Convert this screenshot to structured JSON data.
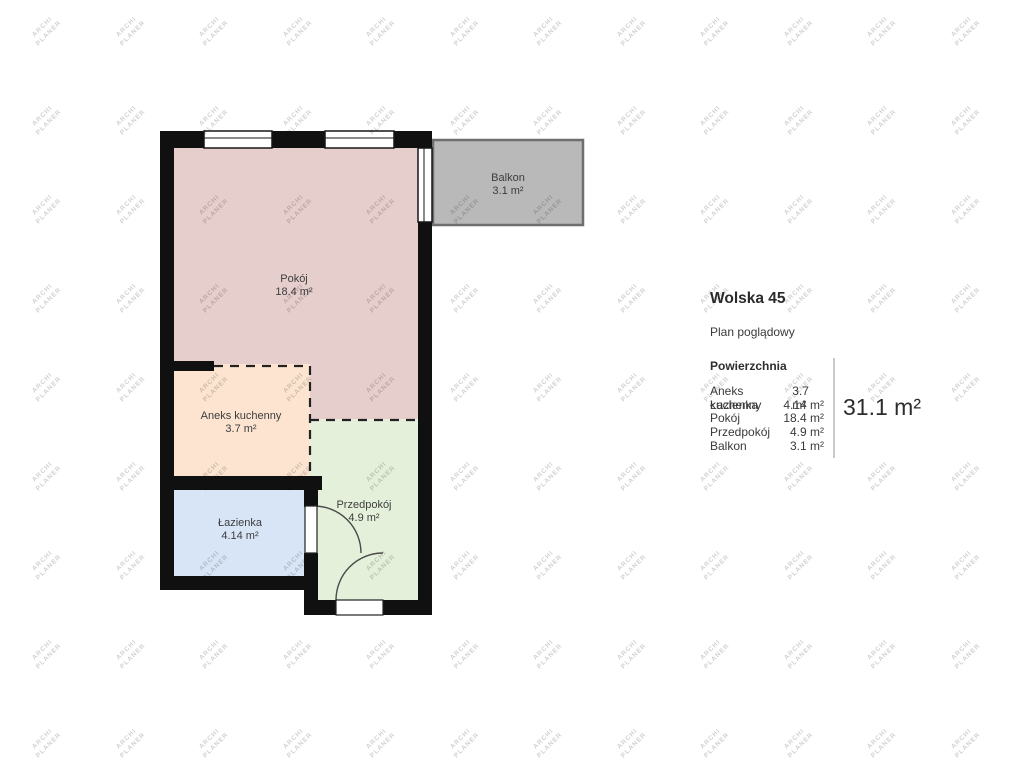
{
  "panel": {
    "title": "Wolska 45",
    "subtitle": "Plan poglądowy",
    "section_heading": "Powierzchnia",
    "rows": [
      {
        "label": "Aneks kuchenny",
        "value": "3.7 m²"
      },
      {
        "label": "Łazienka",
        "value": "4.14 m²"
      },
      {
        "label": "Pokój",
        "value": "18.4 m²"
      },
      {
        "label": "Przedpokój",
        "value": "4.9 m²"
      },
      {
        "label": "Balkon",
        "value": "3.1 m²"
      }
    ],
    "total": "31.1 m²"
  },
  "plan": {
    "wall_color": "#101010",
    "rooms": [
      {
        "name": "Pokój",
        "area": "18.4 m²",
        "color": "#e6cecd"
      },
      {
        "name": "Aneks kuchenny",
        "area": "3.7 m²",
        "color": "#fce4d0"
      },
      {
        "name": "Łazienka",
        "area": "4.14 m²",
        "color": "#d8e5f6"
      },
      {
        "name": "Przedpokój",
        "area": "4.9 m²",
        "color": "#e4f0da"
      },
      {
        "name": "Balkon",
        "area": "3.1 m²",
        "color": "#b9b9b9"
      }
    ],
    "balcony_border": "#6e6e6e"
  },
  "watermark": {
    "line1": "ARCHI",
    "line2": "PLANER",
    "color": "#d2d2d2"
  }
}
